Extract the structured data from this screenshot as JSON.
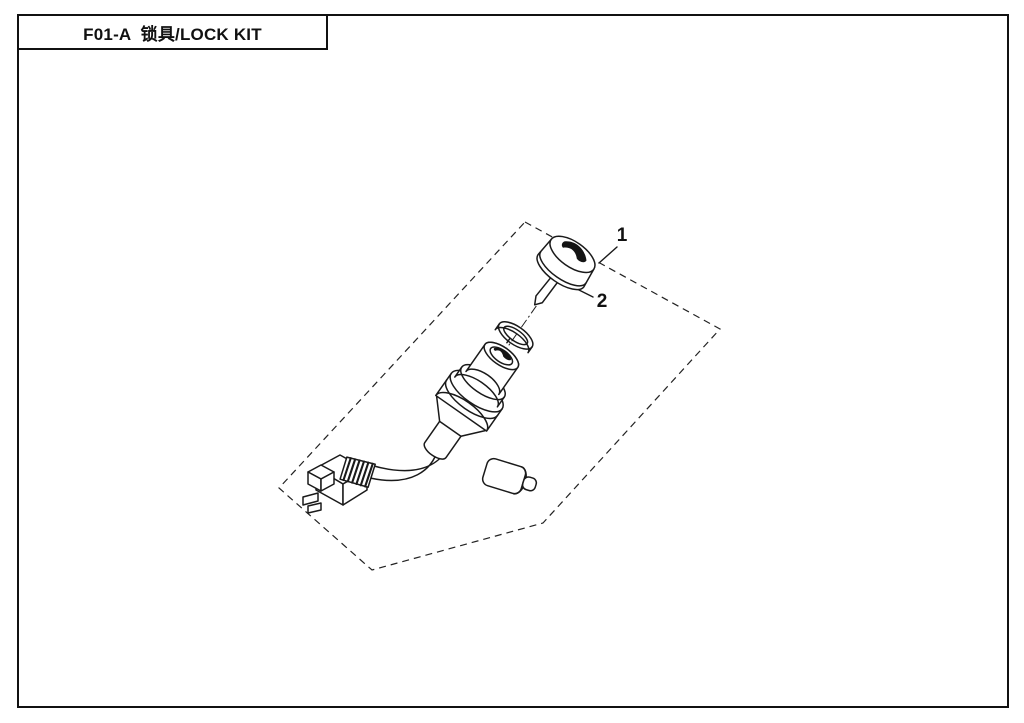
{
  "title_block": {
    "title": "F01-A  锁具/LOCK KIT"
  },
  "diagram": {
    "labels": [
      "1",
      "2"
    ],
    "line_color": "#1a1a1a",
    "background": "#ffffff"
  }
}
